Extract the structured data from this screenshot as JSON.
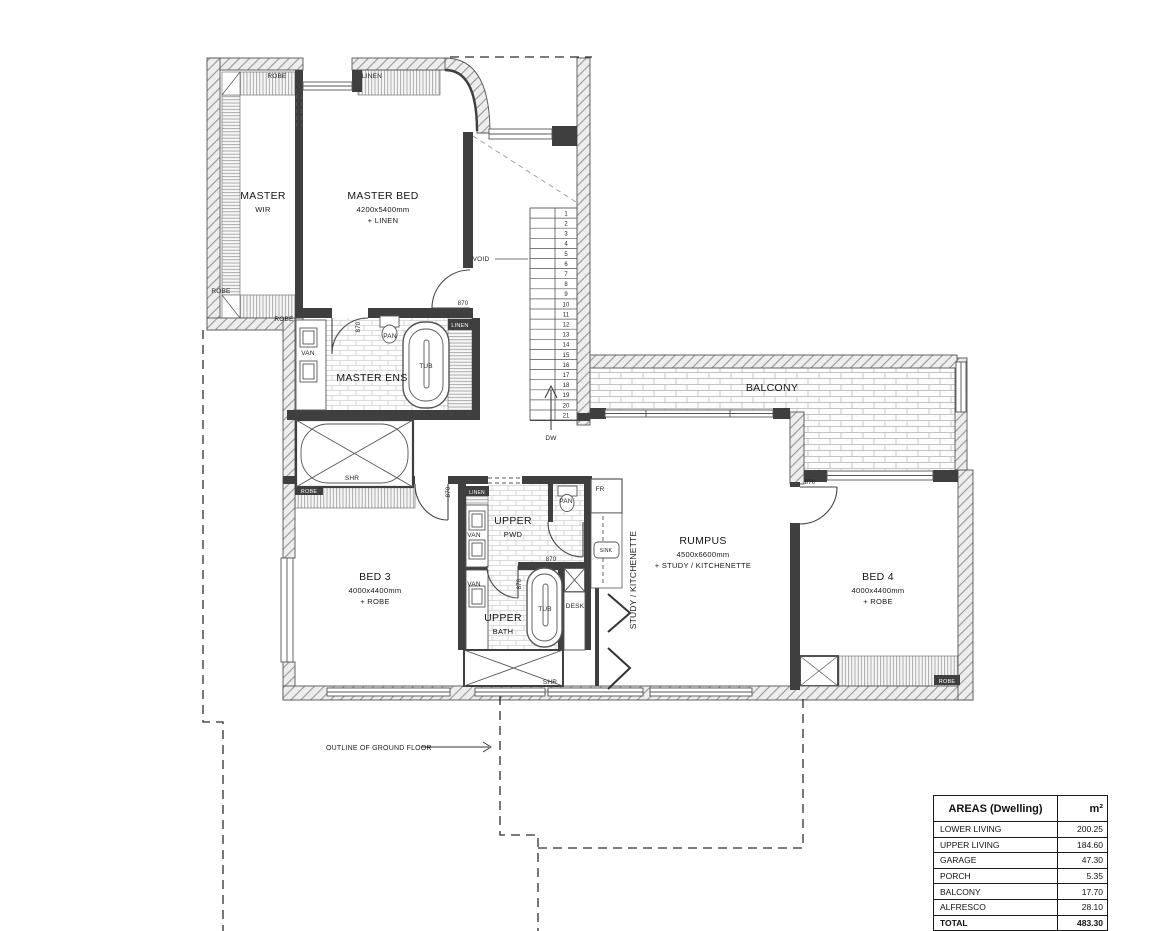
{
  "plan": {
    "rooms": [
      {
        "name": "master-wir",
        "x": 263,
        "y": 199,
        "lines": [
          "MASTER",
          "WIR"
        ]
      },
      {
        "name": "master-bed",
        "x": 383,
        "y": 199,
        "lines": [
          "MASTER BED",
          "4200x5400mm",
          "+ LINEN"
        ]
      },
      {
        "name": "master-ens",
        "x": 372,
        "y": 381,
        "lines": [
          "MASTER ENS"
        ]
      },
      {
        "name": "bed-3",
        "x": 375,
        "y": 580,
        "lines": [
          "BED 3",
          "4000x4400mm",
          "+ ROBE"
        ]
      },
      {
        "name": "upper-pwd",
        "x": 513,
        "y": 524,
        "lines": [
          "UPPER",
          "PWD"
        ]
      },
      {
        "name": "upper-bath",
        "x": 503,
        "y": 621,
        "lines": [
          "UPPER",
          "BATH"
        ]
      },
      {
        "name": "rumpus",
        "x": 703,
        "y": 544,
        "lines": [
          "RUMPUS",
          "4500x6600mm",
          "+ STUDY / KITCHENETTE"
        ]
      },
      {
        "name": "bed-4",
        "x": 878,
        "y": 580,
        "lines": [
          "BED 4",
          "4000x4400mm",
          "+ ROBE"
        ]
      },
      {
        "name": "balcony",
        "x": 772,
        "y": 391,
        "lines": [
          "BALCONY"
        ]
      }
    ],
    "labels": [
      {
        "text": "ROBE",
        "x": 277,
        "y": 78
      },
      {
        "text": "LINEN",
        "x": 372,
        "y": 78
      },
      {
        "text": "ROBE",
        "x": 221,
        "y": 293
      },
      {
        "text": "ROBE",
        "x": 284,
        "y": 321
      },
      {
        "text": "VAN",
        "x": 308,
        "y": 355
      },
      {
        "text": "PAN",
        "x": 390,
        "y": 338
      },
      {
        "text": "TUB",
        "x": 426,
        "y": 368
      },
      {
        "text": "LINEN",
        "x": 460,
        "y": 327,
        "fill": "#ffffff",
        "fs": 5.5
      },
      {
        "text": "870",
        "x": 463,
        "y": 305,
        "fs": 6
      },
      {
        "text": "870",
        "x": 360,
        "y": 327,
        "rot": -90,
        "fs": 6
      },
      {
        "text": "VOID",
        "x": 481,
        "y": 261
      },
      {
        "text": "DW",
        "x": 551,
        "y": 440
      },
      {
        "text": "SHR",
        "x": 352,
        "y": 480
      },
      {
        "text": "ROBE",
        "x": 309,
        "y": 493,
        "fill": "#ffffff",
        "fs": 5.5
      },
      {
        "text": "LINEN",
        "x": 477,
        "y": 494,
        "fill": "#ffffff",
        "fs": 5
      },
      {
        "text": "VAN",
        "x": 474,
        "y": 537
      },
      {
        "text": "PAN",
        "x": 566,
        "y": 503
      },
      {
        "text": "FR",
        "x": 600,
        "y": 491
      },
      {
        "text": "SINK",
        "x": 606,
        "y": 552,
        "fs": 5
      },
      {
        "text": "870",
        "x": 450,
        "y": 492,
        "rot": -90,
        "fs": 6
      },
      {
        "text": "870",
        "x": 551,
        "y": 561,
        "fs": 6
      },
      {
        "text": "870",
        "x": 521,
        "y": 584,
        "rot": -90,
        "fs": 6
      },
      {
        "text": "VAN",
        "x": 474,
        "y": 586
      },
      {
        "text": "TUB",
        "x": 545,
        "y": 611
      },
      {
        "text": "DESK",
        "x": 575,
        "y": 608
      },
      {
        "text": "SHR",
        "x": 550,
        "y": 684
      },
      {
        "text": "STUDY / KITCHENETTE",
        "x": 636,
        "y": 580,
        "rot": -90,
        "fs": 8.5
      },
      {
        "text": "870",
        "x": 810,
        "y": 484,
        "fs": 6
      },
      {
        "text": "ROBE",
        "x": 947,
        "y": 683,
        "fill": "#ffffff",
        "fs": 5.5
      },
      {
        "text": "OUTLINE OF GROUND FLOOR",
        "x": 326,
        "y": 750,
        "fs": 7,
        "anchor": "start"
      }
    ],
    "stairs": {
      "tread_count": 21,
      "direction_label": "DW"
    }
  },
  "areas_table": {
    "header": {
      "col1": "AREAS (Dwelling)",
      "col2": "m²"
    },
    "rows": [
      {
        "label": "LOWER LIVING",
        "value": "200.25"
      },
      {
        "label": "UPPER LIVING",
        "value": "184.60"
      },
      {
        "label": "GARAGE",
        "value": "47.30"
      },
      {
        "label": "PORCH",
        "value": "5.35"
      },
      {
        "label": "BALCONY",
        "value": "17.70"
      },
      {
        "label": "ALFRESCO",
        "value": "28.10"
      },
      {
        "label": "TOTAL",
        "value": "483.30",
        "total": true
      }
    ]
  },
  "colors": {
    "wall": "#3f3f3f",
    "line": "#555555",
    "accent": "#1a1a1a"
  }
}
